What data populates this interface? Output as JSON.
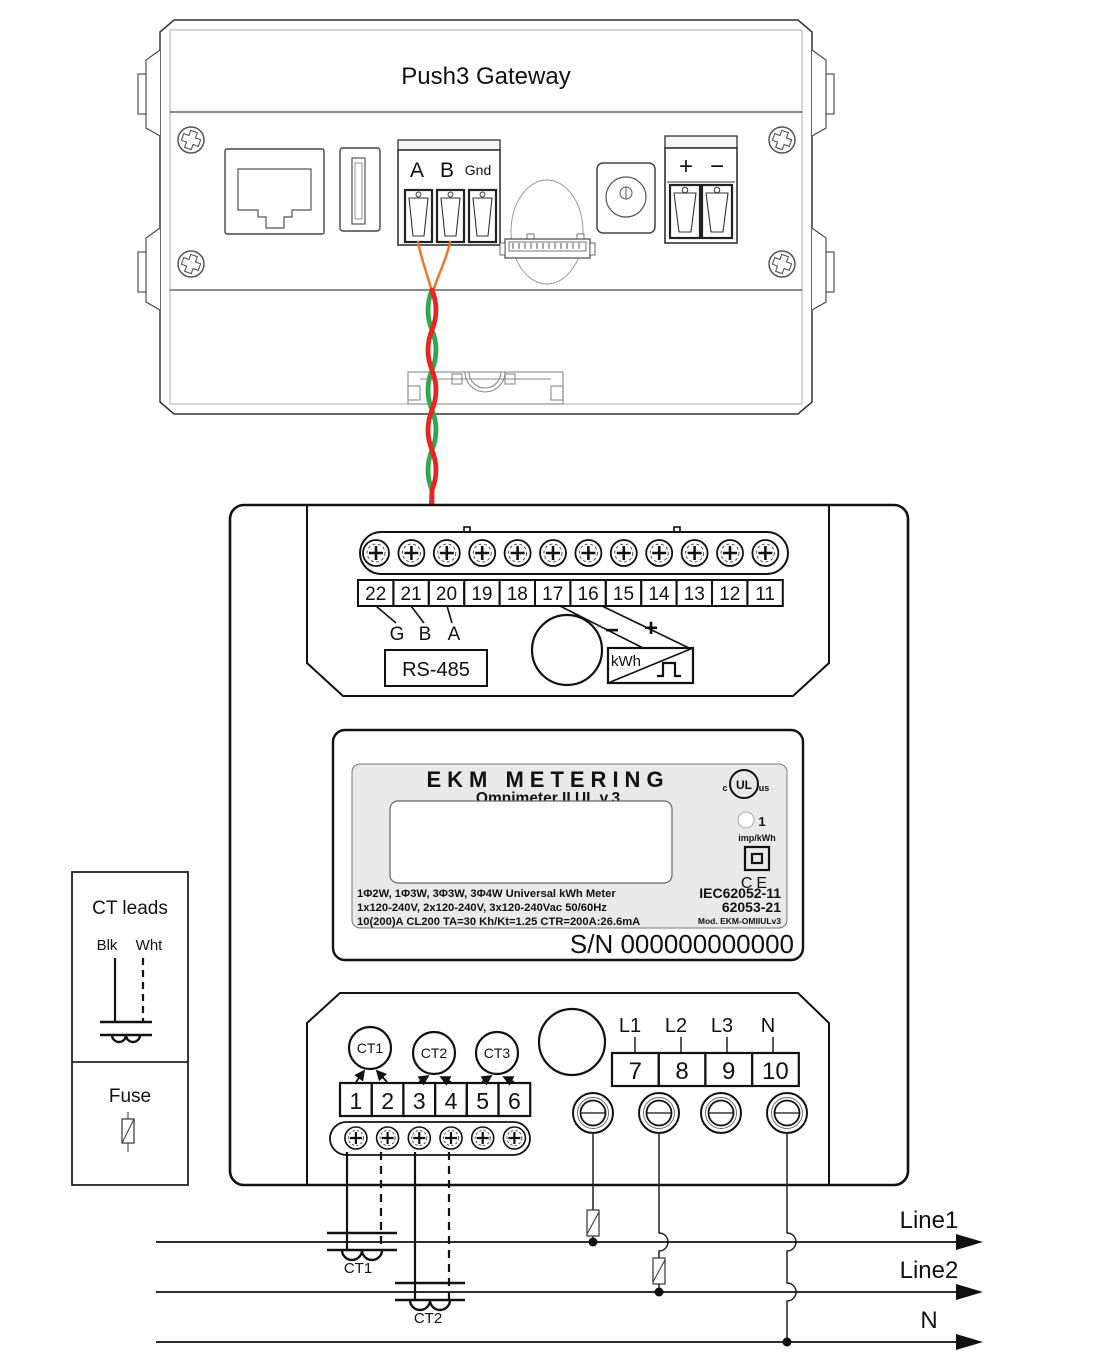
{
  "gateway": {
    "title": "Push3 Gateway",
    "rs485_block": {
      "a": "A",
      "b": "B",
      "gnd": "Gnd"
    },
    "power_block": {
      "plus": "+",
      "minus": "−"
    }
  },
  "meter": {
    "top_terminals": [
      "22",
      "21",
      "20",
      "19",
      "18",
      "17",
      "16",
      "15",
      "14",
      "13",
      "12",
      "11"
    ],
    "rs485_pins": {
      "g": "G",
      "b": "B",
      "a": "A"
    },
    "rs485_label": "RS-485",
    "pulse_output": {
      "minus": "−",
      "plus": "+",
      "kwh": "kWh"
    },
    "nameplate": {
      "brand": "EKM METERING",
      "model": "Omnimeter II UL v.3",
      "ul_left": "c",
      "ul_center": "UL",
      "ul_right": "us",
      "led_value": "1",
      "led_unit": "imp/kWh",
      "ce_mark": "CE",
      "spec_line1": "1Φ2W, 1Φ3W, 3Φ3W, 3Φ4W Universal kWh Meter",
      "spec_line2": "1x120-240V, 2x120-240V, 3x120-240Vac 50/60Hz",
      "spec_line3": "10(200)A CL200 TA=30 Kh/Kt=1.25 CTR=200A:26.6mA",
      "cert_line1": "IEC62052-11",
      "cert_line2": "62053-21",
      "cert_line3": "Mod. EKM-OMIIULv3",
      "serial": "S/N 000000000000"
    },
    "ct_ports": [
      "CT1",
      "CT2",
      "CT3"
    ],
    "ct_terminals": [
      "1",
      "2",
      "3",
      "4",
      "5",
      "6"
    ],
    "line_labels": [
      "L1",
      "L2",
      "L3",
      "N"
    ],
    "line_terminals": [
      "7",
      "8",
      "9",
      "10"
    ]
  },
  "legend": {
    "title": "CT leads",
    "black_lead": "Blk",
    "white_lead": "Wht",
    "fuse": "Fuse"
  },
  "circuit": {
    "line1": "Line1",
    "line2": "Line2",
    "neutral": "N",
    "ct1": "CT1",
    "ct2": "CT2"
  },
  "colors": {
    "wire_red": "#e8251f",
    "wire_green": "#2fa84e",
    "wire_orange": "#f4731f",
    "label_gray": "#e9e9e9"
  }
}
